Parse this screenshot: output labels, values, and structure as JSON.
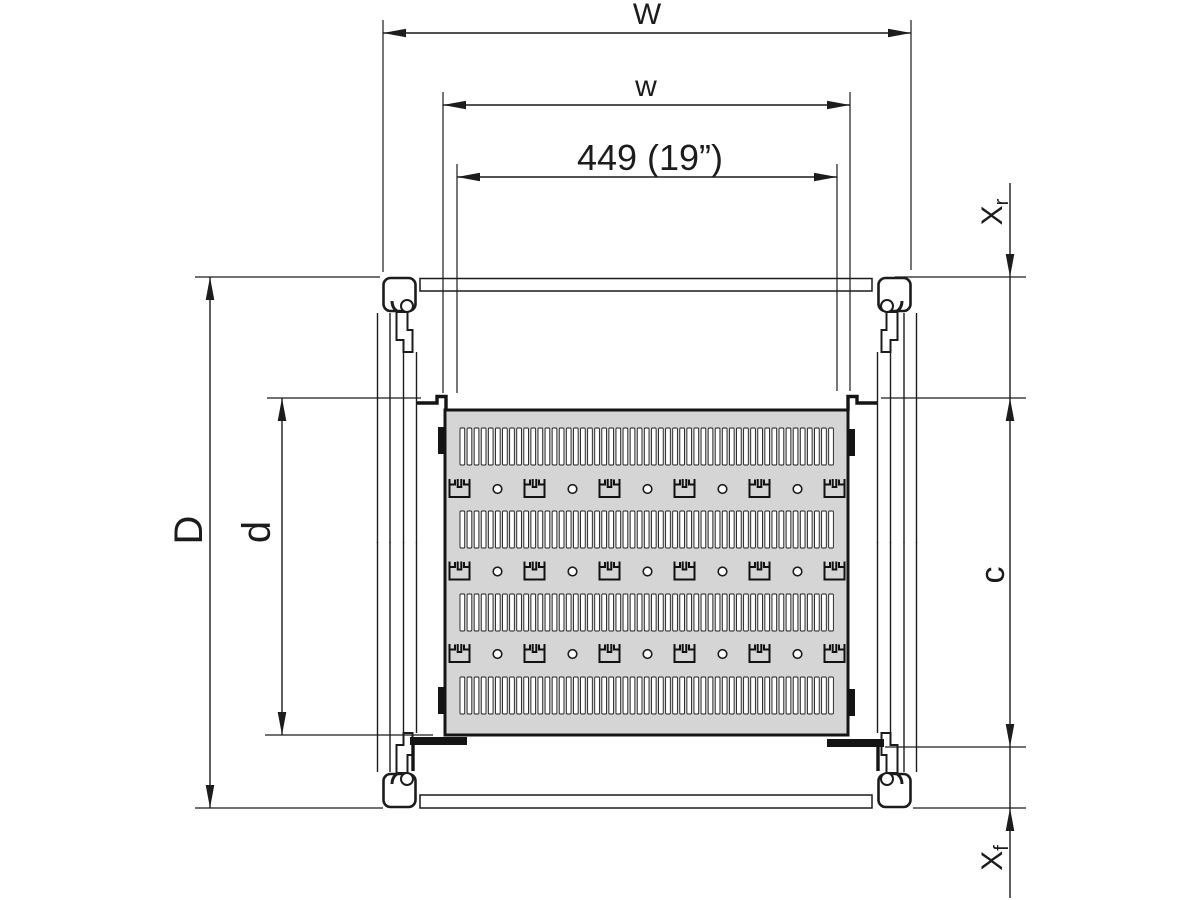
{
  "drawing": {
    "subject": "19-inch rack static shelf - top view technical drawing",
    "dimensions": {
      "overall_width": "W",
      "usable_width": "w",
      "mounting_width": "449 (19”)",
      "overall_depth": "D",
      "usable_depth": "d",
      "shelf_depth": "c",
      "rear_offset_main": "X",
      "rear_offset_sub": "r",
      "front_offset_main": "X",
      "front_offset_sub": "f"
    },
    "shelf_pattern": {
      "slot_rows": 4,
      "slots_per_row": 53,
      "tie_rows": 3,
      "ties_per_row": 6,
      "holes_per_row": 5
    },
    "colors": {
      "line": "#1c1c1c",
      "shelf_fill": "#d5d5d5",
      "background": "#ffffff"
    }
  }
}
